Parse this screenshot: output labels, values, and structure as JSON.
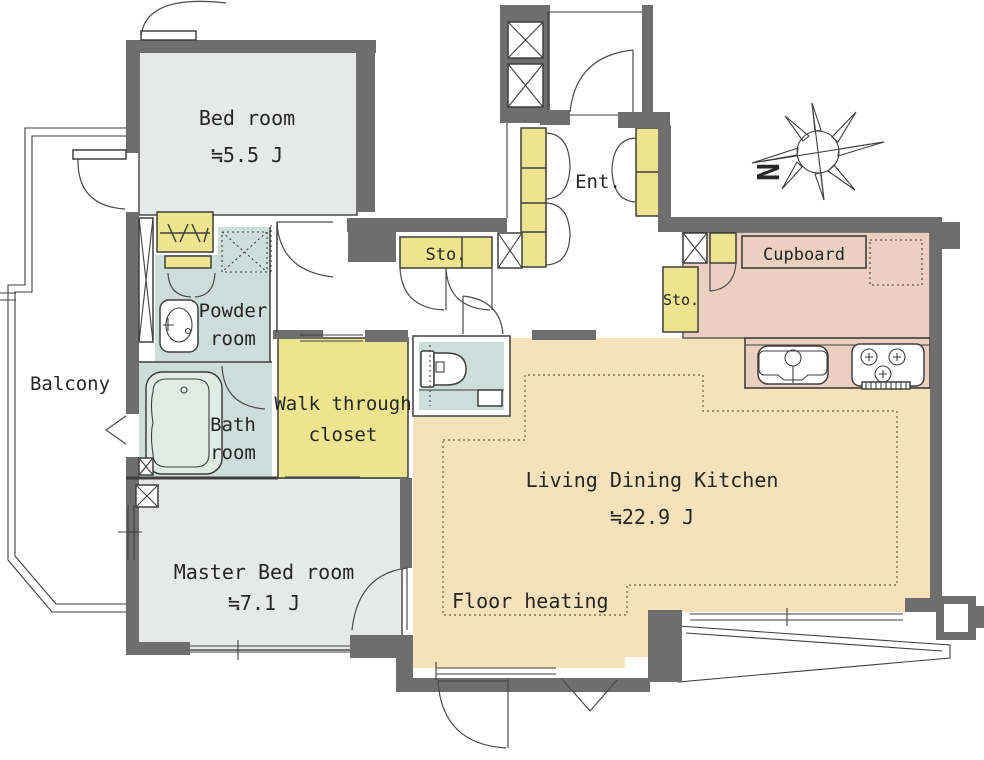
{
  "colors": {
    "wall": "#6e6e6e",
    "line": "#3f3f3f",
    "room_gray": "#e7e9e9",
    "ldk_cream": "#f5e2ba",
    "kitchen_pink": "#ebcfc0",
    "cabinet_yellow": "#ece48f",
    "wet_blue": "#cdddd9",
    "text": "#262626",
    "paper": "#ffffff"
  },
  "rooms": {
    "bedroom": {
      "label": "Bed room",
      "area": "≒5.5 J"
    },
    "master": {
      "label": "Master Bed room",
      "area": "≒7.1 J"
    },
    "ldk": {
      "label": "Living Dining Kitchen",
      "area": "≒22.9 J"
    },
    "floor_heating": "Floor heating",
    "balcony": "Balcony",
    "entrance": "Ent.",
    "storage_hall": "Sto.",
    "storage_kitchen": "Sto.",
    "cupboard": "Cupboard",
    "powder": {
      "line1": "Powder",
      "line2": "room"
    },
    "bath": {
      "line1": "Bath",
      "line2": "room"
    },
    "wtc": {
      "line1": "Walk through",
      "line2": "closet"
    }
  },
  "compass": {
    "north": "N"
  }
}
